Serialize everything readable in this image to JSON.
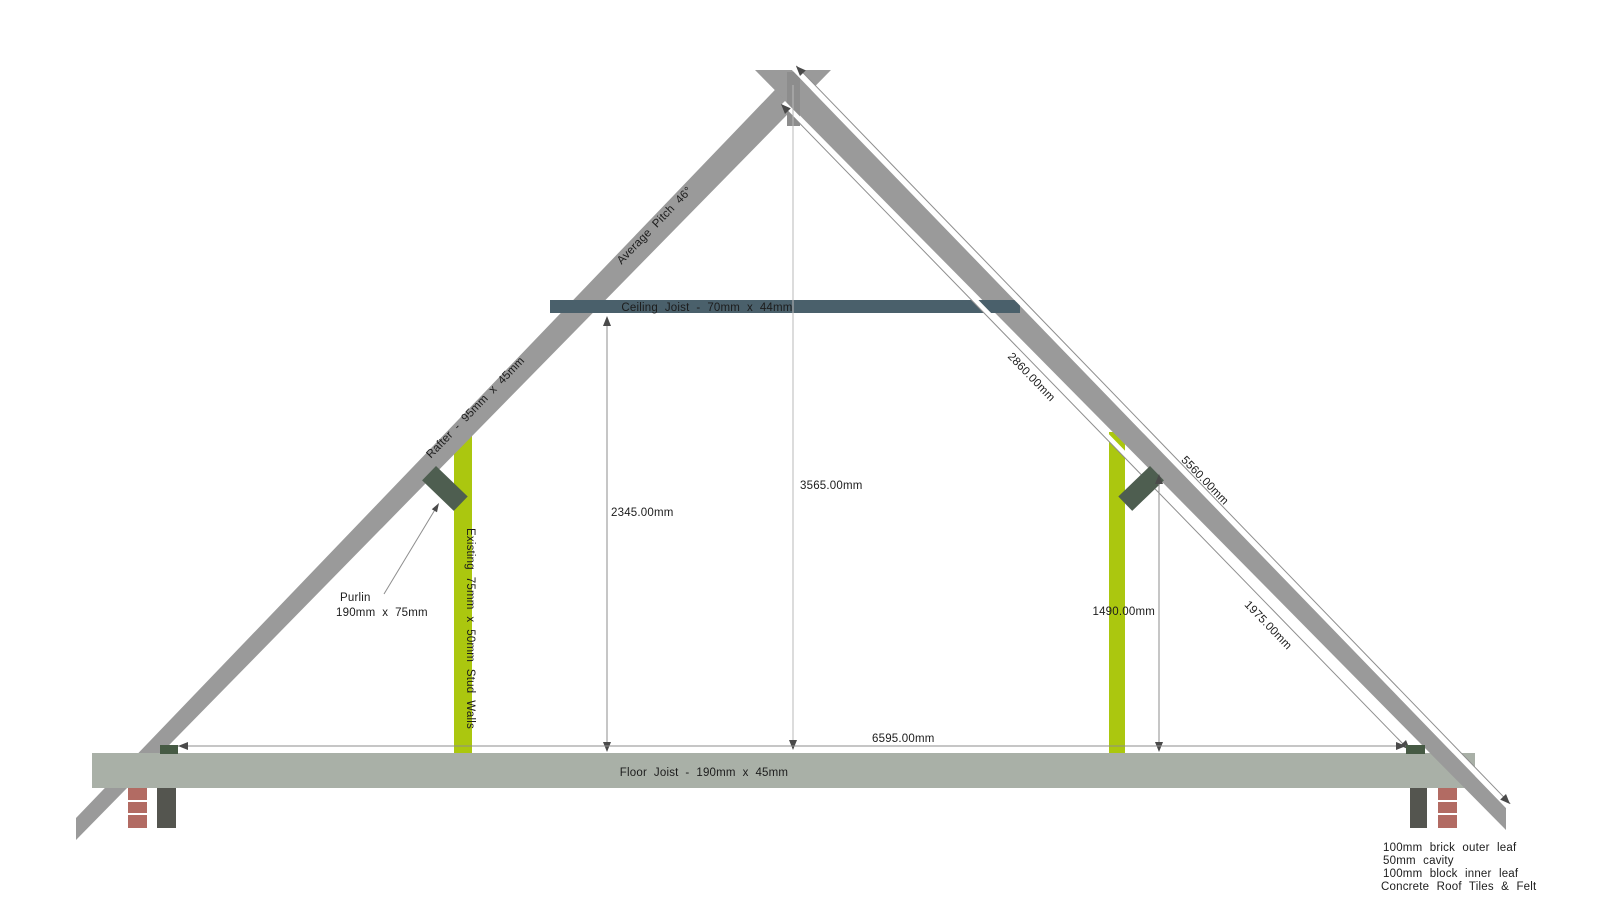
{
  "drawing": {
    "type": "roof-loft-section",
    "labels": {
      "average_pitch": "Average Pitch 46°",
      "rafter_size": "Rafter - 95mm x 45mm",
      "ceiling_joist": "Ceiling Joist - 70mm x 44mm",
      "floor_joist": "Floor Joist - 190mm x 45mm",
      "stud_walls": "Existing 75mm x 50mm Stud Walls",
      "purlin_name": "Purlin",
      "purlin_size": "190mm x 75mm"
    },
    "dimensions": {
      "rafter_upper_segment": "2860.00mm",
      "rafter_total": "5560.00mm",
      "rafter_lower_segment": "1975.00mm",
      "ridge_height": "3565.00mm",
      "ceiling_height": "2345.00mm",
      "purlin_height": "1490.00mm",
      "internal_span": "6595.00mm"
    },
    "wall_spec": {
      "lines": [
        "100mm brick outer leaf",
        "50mm cavity",
        "100mm block inner leaf",
        "Concrete Roof Tiles & Felt"
      ]
    },
    "colors": {
      "rafter": "#9a9a9a",
      "ridge": "#8d8d8d",
      "ceiling_joist": "#4a606b",
      "floor_joist": "#a9b0a7",
      "stud_wall": "#abc70f",
      "purlin": "#4e5e50",
      "wall_plate": "#465a44",
      "brick": "#b26b63",
      "block": "#54554f",
      "band": "#ffffff"
    }
  }
}
